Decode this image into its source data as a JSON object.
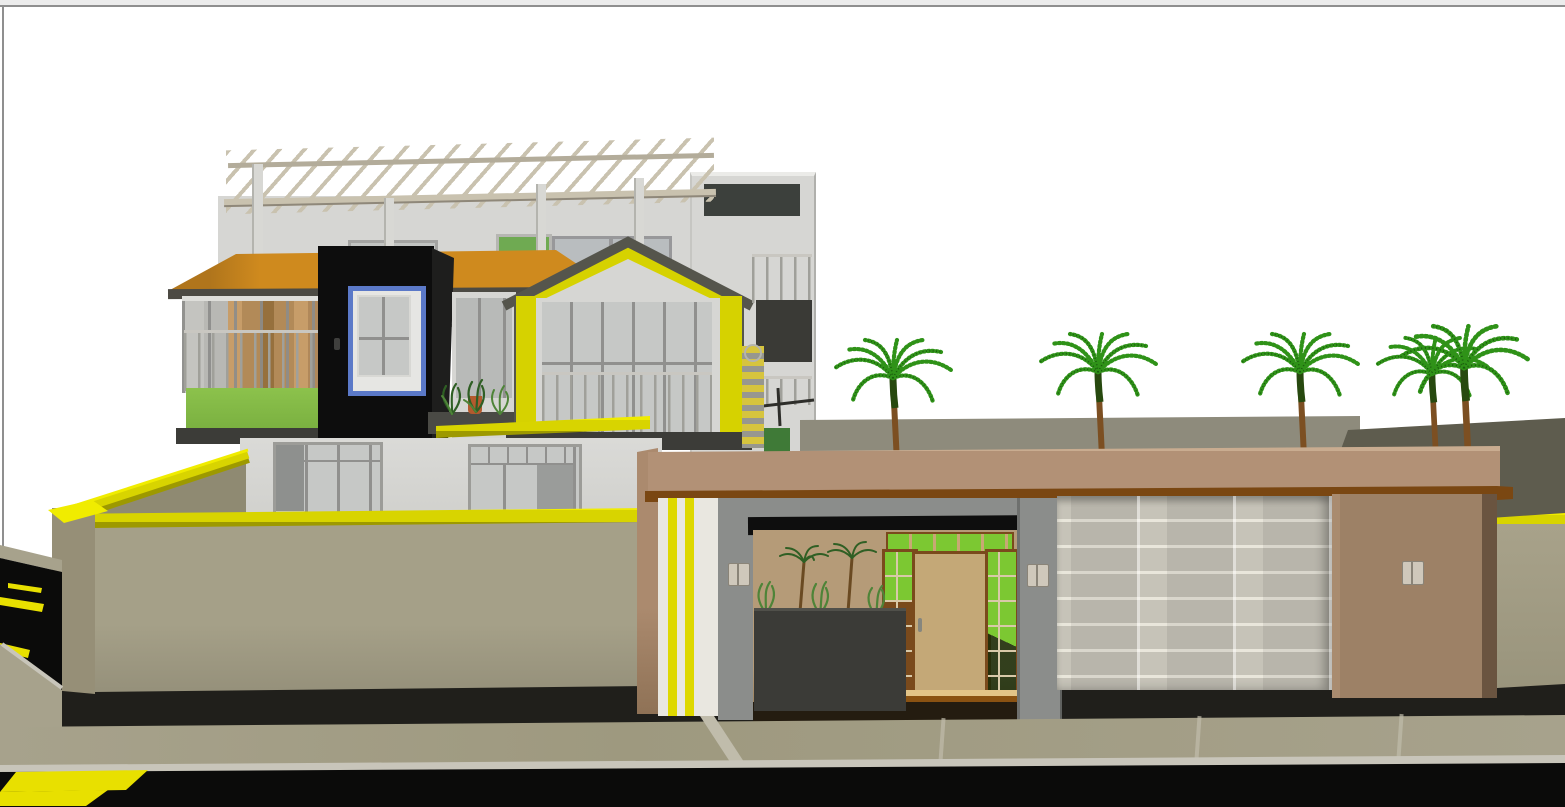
{
  "view": {
    "type": "3d-architectural-render",
    "subject": "two-storey modern villa with rooftop pergola, compound wall, entrance gate, garage and palm trees on a street corner with crosswalk",
    "background": "white"
  },
  "objects": [
    "rooftop-pergola",
    "orange-awning-roof",
    "black-feature-volume",
    "blue-frame-window",
    "yellow-gable-pavilion",
    "glass-balcony-railing",
    "green-balcony-panel",
    "wood-clad-interior",
    "stair-tower",
    "compound-wall",
    "yellow-wall-coping",
    "entrance-canopy",
    "striped-gate-pillar",
    "wooden-entrance-door",
    "green-glass-sidelights",
    "entry-planter",
    "wall-sconces",
    "garage-roller-door",
    "palm-trees",
    "street-sidewalk",
    "pedestrian-crosswalk",
    "side-street"
  ],
  "palette": {
    "sky": "#ffffff",
    "frame_strip": "#ececec",
    "frame_border": "#8f8f8f",
    "house_wall": "#d6d6d3",
    "house_wall_dark": "#c9c9c5",
    "parapet": "#e4e4e1",
    "slab": "#3c3c38",
    "roof_orange": "#cf8a1e",
    "roof_orange_dark": "#b0751c",
    "roof_eave": "#4c4a43",
    "box_black": "#0d0d0d",
    "box_side": "#1e1e1d",
    "blue_frame": "#5b79c8",
    "pane": "#c6c8c6",
    "pane_dark": "#8e908e",
    "mullion": "#90908e",
    "frame_light": "#e6e6e3",
    "glass_green": "#6faa52",
    "transom_green": "#7cc832",
    "wood_a": "#b28a58",
    "wood_b": "#96703d",
    "wood_c": "#c79d69",
    "balcony_green": "#8cc24c",
    "gable_yellow": "#d6d200",
    "gable_trim": "#55554c",
    "coping": "#d8d400",
    "coping_hi": "#f0ec00",
    "coping_lo": "#9d9900",
    "wall_olive": "#a5a088",
    "wall_olive_dark": "#95907a",
    "wall_corner": "#968f77",
    "wall_base": "#201f1b",
    "return_face": "#8f8a72",
    "rear_olive": "#8e8b7c",
    "rear_olive_dark": "#5e5c4e",
    "far_wall": "#a8a28a",
    "canopy": "#b29176",
    "canopy_hi": "#c9ac90",
    "canopy_rail": "#7a4712",
    "stripe_yellow": "#ded800",
    "stripe_white": "#e9e7e0",
    "pillar_brown": "#ab8a6e",
    "pillar_gray": "#8b8d8b",
    "pillar_gray_dark": "#6e706e",
    "lintel": "#0e0e0e",
    "recess_wall": "#b59b78",
    "recess_wall_dark": "#9a815f",
    "door_wood": "#c4a877",
    "door_frame": "#7a4a1c",
    "threshold": "#8a5212",
    "threshold_hi": "#e2c488",
    "recess_floor": "#241c10",
    "planter": "#3b3b37",
    "plant": "#4e8438",
    "plant_dark": "#2f5f24",
    "pot": "#b45a2e",
    "garage": "#c6c3b8",
    "garage_seam": "#e9e6db",
    "right_pillar": "#9d8166",
    "right_pillar_edge": "#6a5440",
    "sconce": "#cfc8bb",
    "sconce_edge": "#8a8478",
    "sidewalk": "#a7a28c",
    "sidewalk_joint": "#c0bcab",
    "curb": "#c8c5ba",
    "road": "#0b0b0a",
    "crosswalk": "#e8e000",
    "pergola_wood": "#c9c2af",
    "pergola_post": "#d8d8d4",
    "pergola_beam": "#b3ac9a",
    "stair_yellow": "#d6c43e",
    "stair_gray": "#97978f",
    "tower_inset": "#3c403c",
    "tower_opening": "#3a3a36",
    "tower_door": "#3f7a37",
    "palm_trunk": "#7c4f22",
    "palm_trunk_dark": "#27490f",
    "palm_green": "#2f9218",
    "palm_green_dark": "#1a5c0e"
  }
}
